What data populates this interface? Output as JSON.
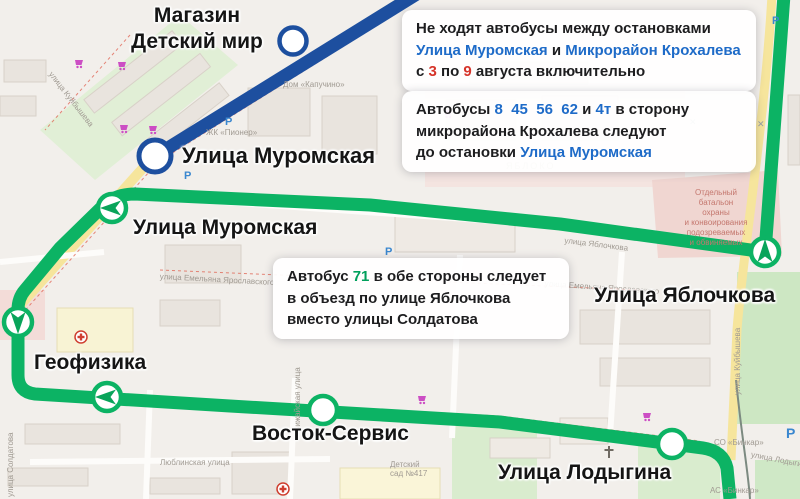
{
  "colors": {
    "route_green": "#0cb364",
    "route_blue": "#1d4f9f",
    "link_blue": "#1e6bc8",
    "number_red": "#d6342a",
    "number_green": "#00a05c"
  },
  "notices": {
    "n1": {
      "line1": "Не ходят автобусы между остановками",
      "line2_link1": "Улица Муромская",
      "line2_mid": " и ",
      "line2_link2": "Микрорайон Крохалева",
      "line3_pre": "с ",
      "line3_num1": "3",
      "line3_mid": " по ",
      "line3_num2": "9",
      "line3_post": " августа включительно"
    },
    "n2": {
      "line1_pre": "Автобусы  ",
      "line1_nums": "8  45  56  62",
      "line1_mid": " и ",
      "line1_num2": "4т",
      "line1_post": " в сторону",
      "line2": "микрорайона Крохалева следуют",
      "line3_pre": "до остановки ",
      "line3_link": "Улица Муромская"
    },
    "n3": {
      "line1_pre": "Автобус  ",
      "line1_num": "71",
      "line1_post": " в обе стороны следует",
      "line2": "в объезд по улице Яблочкова",
      "line3": "вместо улицы Солдатова"
    }
  },
  "stops": {
    "detskiy_mir_line1": "Магазин",
    "detskiy_mir_line2": "Детский мир",
    "muromskaya_blue": "Улица Муромская",
    "muromskaya_green": "Улица Муромская",
    "yablochkova": "Улица Яблочкова",
    "geofizika": "Геофизика",
    "vostok_servis": "Восток-Сервис",
    "lodygina": "Улица Лодыгина"
  },
  "map_labels": {
    "dom_kapuchino": "Дом «Капучино»",
    "zk_pioner": "ЖК «Пионер»",
    "yabloko": "ЯБЛОКО",
    "emelyana": "улица Емельяна Ярославского",
    "battalion": "Отдельный\nбатальон\nохраны\nи конвоирования\nподозреваемых\nи обвиняемых",
    "kuybysheva": "улица Куйбышева",
    "soldatova": "улица Солдатова",
    "vizhayskaya": "Вижайская улица",
    "lyublinskaya": "Люблинская улица",
    "detsad": "Детский\nсад №417",
    "yablochkova_street": "улица Яблочкова",
    "lodygina_street": "улица Лодыгина",
    "so_binkar": "СО «Бинкар»",
    "as_binkar": "АС «Бинкар»",
    "parking": "Р"
  }
}
